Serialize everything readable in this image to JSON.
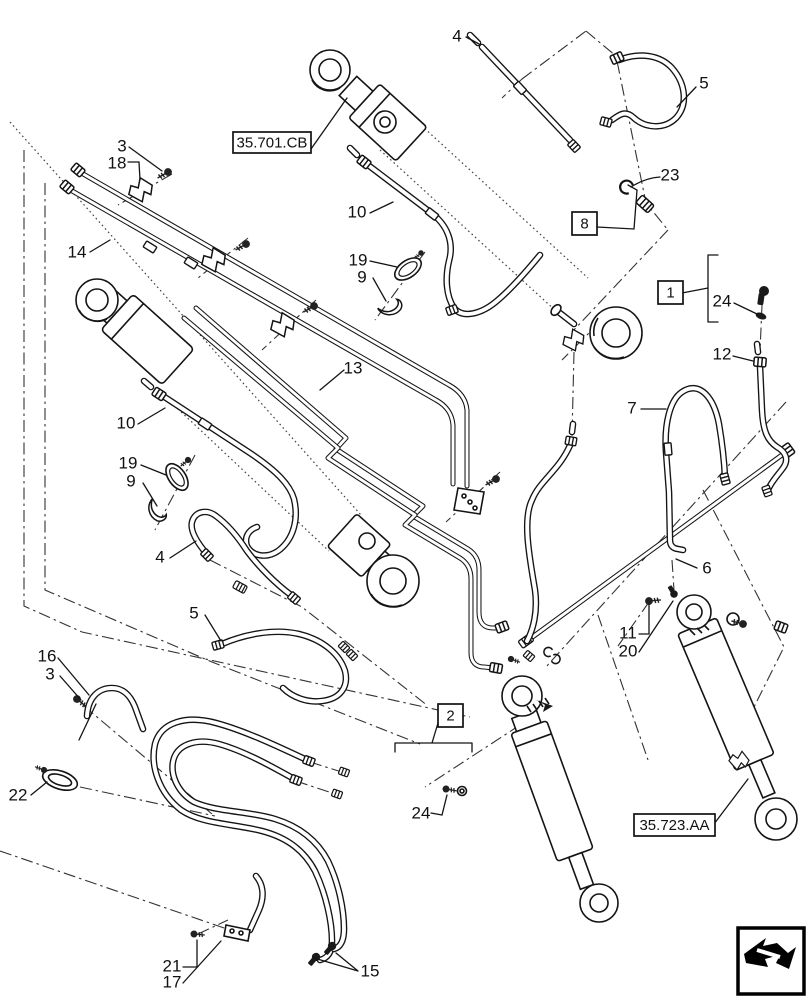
{
  "page": {
    "kind": "exploded-parts-diagram",
    "line_color": "#141414",
    "background": "#ffffff"
  },
  "callouts": [
    {
      "label": "3",
      "x": 122,
      "y": 147
    },
    {
      "label": "18",
      "x": 117,
      "y": 164
    },
    {
      "label": "14",
      "x": 77,
      "y": 253
    },
    {
      "label": "10",
      "x": 357,
      "y": 213
    },
    {
      "label": "19",
      "x": 358,
      "y": 261
    },
    {
      "label": "9",
      "x": 362,
      "y": 278
    },
    {
      "label": "4",
      "x": 457,
      "y": 37
    },
    {
      "label": "5",
      "x": 704,
      "y": 84
    },
    {
      "label": "23",
      "x": 670,
      "y": 176
    },
    {
      "label": "24",
      "x": 722,
      "y": 302
    },
    {
      "label": "13",
      "x": 353,
      "y": 369
    },
    {
      "label": "10",
      "x": 126,
      "y": 424
    },
    {
      "label": "19",
      "x": 128,
      "y": 464
    },
    {
      "label": "9",
      "x": 131,
      "y": 482
    },
    {
      "label": "4",
      "x": 160,
      "y": 558
    },
    {
      "label": "5",
      "x": 194,
      "y": 614
    },
    {
      "label": "16",
      "x": 47,
      "y": 657
    },
    {
      "label": "3",
      "x": 50,
      "y": 675
    },
    {
      "label": "22",
      "x": 18,
      "y": 796
    },
    {
      "label": "21",
      "x": 172,
      "y": 967
    },
    {
      "label": "17",
      "x": 172,
      "y": 983
    },
    {
      "label": "15",
      "x": 370,
      "y": 972
    },
    {
      "label": "12",
      "x": 722,
      "y": 355
    },
    {
      "label": "7",
      "x": 632,
      "y": 409
    },
    {
      "label": "6",
      "x": 707,
      "y": 569
    },
    {
      "label": "11",
      "x": 628,
      "y": 634
    },
    {
      "label": "20",
      "x": 628,
      "y": 652
    },
    {
      "label": "24",
      "x": 421,
      "y": 814
    }
  ],
  "ref_boxes": [
    {
      "label": "35.701.CB",
      "x": 233,
      "y": 132,
      "w": 78,
      "h": 21,
      "link": true
    },
    {
      "label": "8",
      "x": 572,
      "y": 212,
      "w": 25,
      "h": 23,
      "link": false
    },
    {
      "label": "1",
      "x": 658,
      "y": 281,
      "w": 25,
      "h": 23,
      "link": false
    },
    {
      "label": "2",
      "x": 438,
      "y": 704,
      "w": 25,
      "h": 23,
      "link": false
    },
    {
      "label": "35.723.AA",
      "x": 634,
      "y": 814,
      "w": 81,
      "h": 22,
      "link": true
    }
  ],
  "logo": {
    "name": "page-turn-arrow"
  }
}
